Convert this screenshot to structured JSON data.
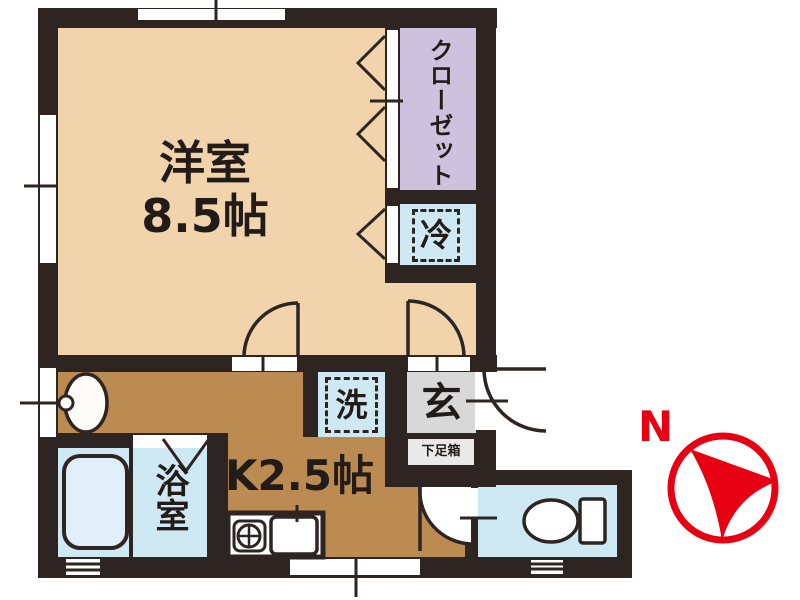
{
  "floorplan": {
    "main_room": {
      "name": "洋室",
      "size": "8.5帖"
    },
    "closet": {
      "name": "クローゼット"
    },
    "refrigerator_space": {
      "name": "冷"
    },
    "laundry_space": {
      "name": "洗"
    },
    "entrance": {
      "name": "玄",
      "shoe_box": "下足箱"
    },
    "bathroom": {
      "name": "浴室"
    },
    "kitchen": {
      "name": "K2.5帖"
    },
    "compass": {
      "north": "N"
    }
  },
  "colors": {
    "wall": "#2e2522",
    "main_room_fill": "#f1d3ac",
    "kitchen_fill": "#bc8b52",
    "closet_fill": "#cdc2de",
    "water_area_fill": "#cfe9f4",
    "entrance_fill": "#d8d8d8",
    "compass_red": "#e60012"
  }
}
